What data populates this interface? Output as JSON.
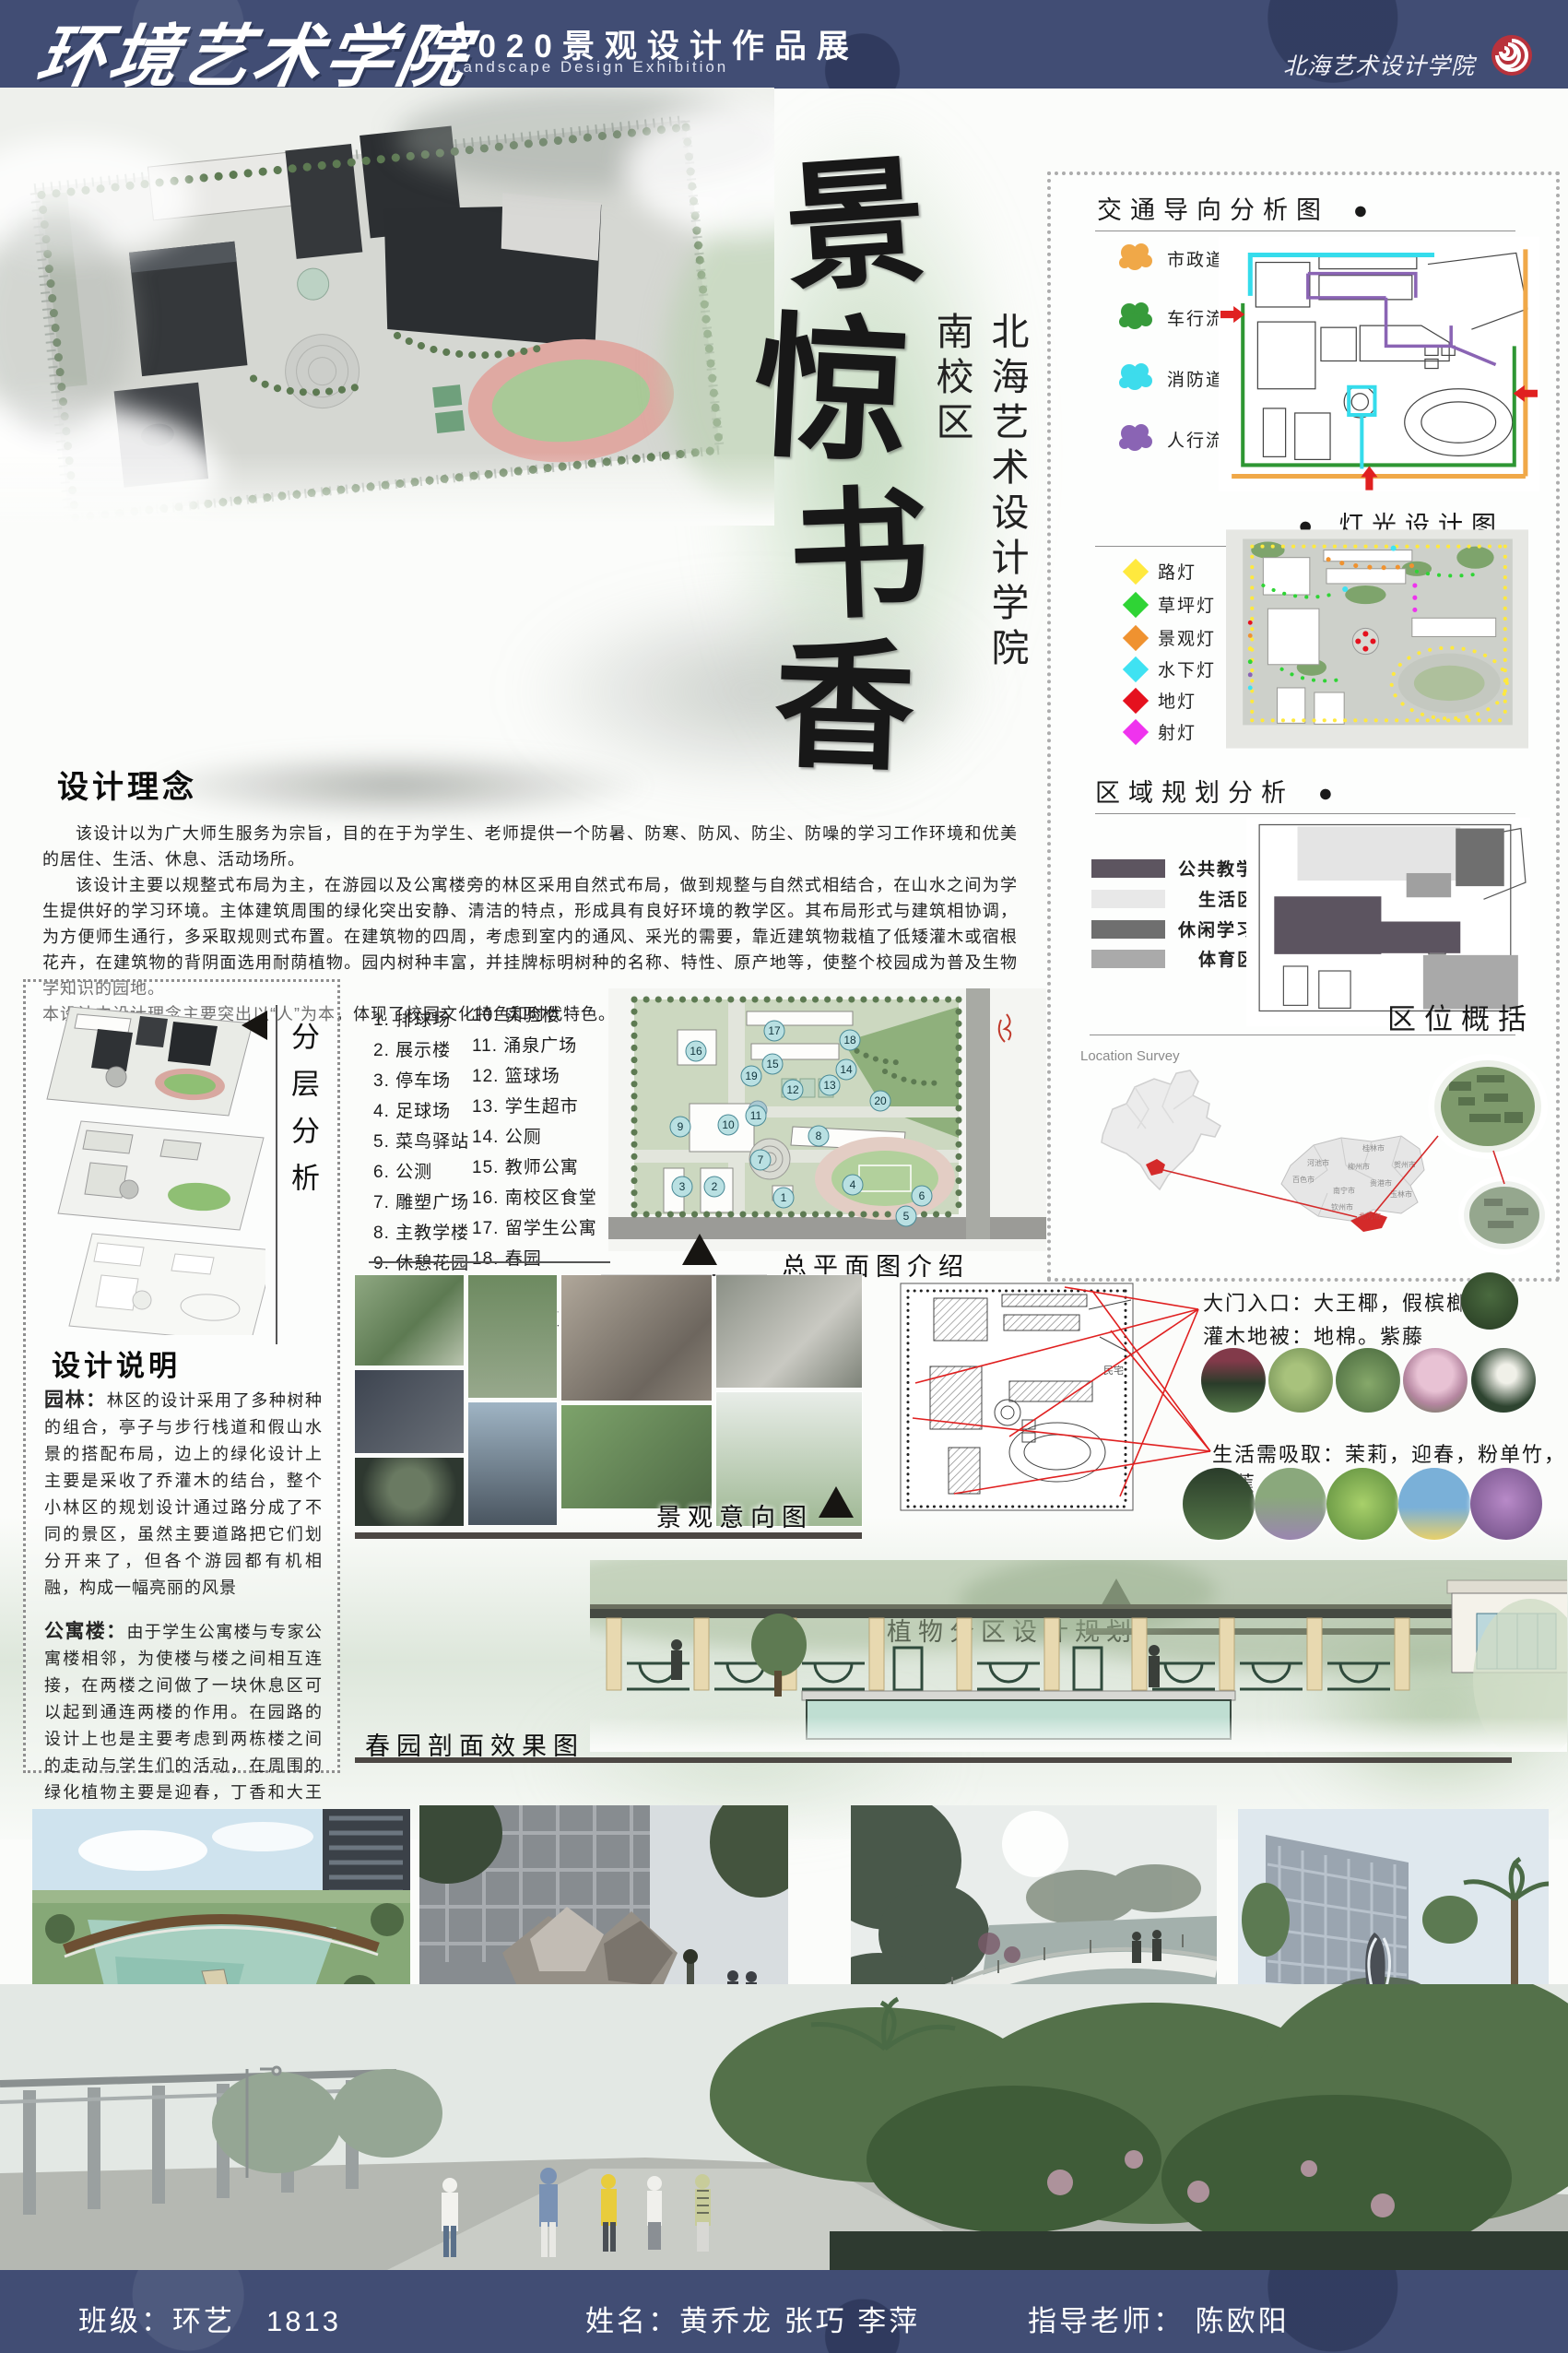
{
  "header": {
    "school_title": "环境艺术学院",
    "exhibition_title": "2020景观设计作品展",
    "exhibition_subtitle": "Landscape Design Exhibition",
    "logo_text": "北海艺术设计学院",
    "accent_red": "#b8323c"
  },
  "hero_title": {
    "char1": "景",
    "char2": "惊",
    "char3": "书",
    "char4": "香",
    "subtitle": "北海艺术设计学院南校区"
  },
  "right_panel": {
    "traffic": {
      "title": "交通导向分析图",
      "bullet": "●",
      "legend": [
        {
          "label": "市政道路",
          "color": "#f0a848"
        },
        {
          "label": "车行流线",
          "color": "#379b3b"
        },
        {
          "label": "消防道路",
          "color": "#3ddcec"
        },
        {
          "label": "人行流线",
          "color": "#8a64b4"
        }
      ]
    },
    "lighting": {
      "title": "灯光设计图",
      "bullet": "●",
      "legend": [
        {
          "label": "路灯",
          "color": "#ffe93e"
        },
        {
          "label": "草坪灯",
          "color": "#2fd435"
        },
        {
          "label": "景观灯",
          "color": "#ef9230"
        },
        {
          "label": "水下灯",
          "color": "#3fe2f2"
        },
        {
          "label": "地灯",
          "color": "#e5111e"
        },
        {
          "label": "射灯",
          "color": "#ef33ee"
        }
      ]
    },
    "zoning": {
      "title": "区域规划分析",
      "bullet": "●",
      "legend": [
        {
          "label": "公共教学区",
          "color": "#5d5560"
        },
        {
          "label": "生活区",
          "color": "#e8e8e8"
        },
        {
          "label": "休闲学习区",
          "color": "#6f6f6f"
        },
        {
          "label": "体育区",
          "color": "#aaaaaa"
        }
      ]
    },
    "location": {
      "title": "区位概括",
      "survey_label": "Location Survey",
      "cities": [
        "河池市",
        "桂林市",
        "柳州市",
        "贺州市",
        "百色市",
        "贵港市",
        "南宁市",
        "玉林市",
        "钦州市",
        "北海市"
      ]
    }
  },
  "design_concept": {
    "title": "设计理念",
    "p1": "该设计以为广大师生服务为宗旨，目的在于为学生、老师提供一个防暑、防寒、防风、防尘、防噪的学习工作环境和优美的居住、生活、休息、活动场所。",
    "p2": "该设计主要以规整式布局为主，在游园以及公寓楼旁的林区采用自然式布局，做到规整与自然式相结合，在山水之间为学生提供好的学习环境。主体建筑周围的绿化突出安静、清洁的特点，形成具有良好环境的教学区。其布局形式与建筑相协调，为方便师生通行，多采取规则式布置。在建筑物的四周，考虑到室内的通风、采光的需要，靠近建筑物栽植了低矮灌木或宿根花卉，在建筑物的背阴面选用耐荫植物。园内树种丰富，并挂牌标明树种的名称、特性、原产地等，使整个校园成为普及生物学知识的园地。",
    "p3": "本设计中设计理念主要突出以“人”为本，体现了校园文化特色和时代特色。"
  },
  "layer_analysis": {
    "title": "分层分析"
  },
  "facility_list": {
    "col1": [
      "1. 排球场",
      "2. 展示楼",
      "3. 停车场",
      "4. 足球场",
      "5. 菜鸟驿站",
      "6. 公测",
      "7. 雕塑广场",
      "8. 主教学楼",
      "9. 休憩花园"
    ],
    "col2": [
      "10. 实验楼",
      "11. 涌泉广场",
      "12. 篮球场",
      "13. 学生超市",
      "14. 公厕",
      "15. 教师公寓",
      "16. 南校区食堂",
      "17. 留学生公寓",
      "18. 春园",
      "19. 梅园",
      "20. 居民区"
    ]
  },
  "master_plan": {
    "caption": "总平面图介绍",
    "markers": [
      "1",
      "2",
      "3",
      "4",
      "5",
      "6",
      "7",
      "8",
      "9",
      "10",
      "11",
      "12",
      "13",
      "14",
      "15",
      "16",
      "17",
      "18",
      "19",
      "20"
    ]
  },
  "design_notes": {
    "title": "设计说明",
    "garden_label": "园林：",
    "garden_text": "林区的设计采用了多种树种的组合，亭子与步行栈道和假山水景的搭配布局，边上的绿化设计上主要是采收了乔灌木的结台，整个小林区的规划设计通过路分成了不同的景区，虽然主要道路把它们划分开来了，但各个游园都有机相融，构成一幅亮丽的风景",
    "apartment_label": "公寓楼：",
    "apartment_text": "由于学生公寓楼与专家公寓楼相邻，为使楼与楼之间相互连接，在两楼之间做了一块休息区可以起到通连两楼的作用。在园路的设计上也是主要考虑到两栋楼之间的走动与学生们的活动，在周围的绿化植物主要是迎春，丁香和大王椰等，给人一种花香四溢的感觉。"
  },
  "intention": {
    "caption": "景观意向图"
  },
  "plants": {
    "caption": "植物分区设计规划",
    "entrance_line": "大门入口：大王椰，假槟榔樟树",
    "shrub_line": "灌木地被：地棉。紫藤",
    "life_line": "生活需吸取：茉莉，迎春，粉单竹，芭蕉",
    "plan_note": "民宅"
  },
  "section_view": {
    "caption": "春园剖面效果图"
  },
  "footer": {
    "class_label": "班级：环艺　1813",
    "name_label": "姓名：黄乔龙 张巧 李萍",
    "advisor_label": "指导老师： 陈欧阳"
  }
}
